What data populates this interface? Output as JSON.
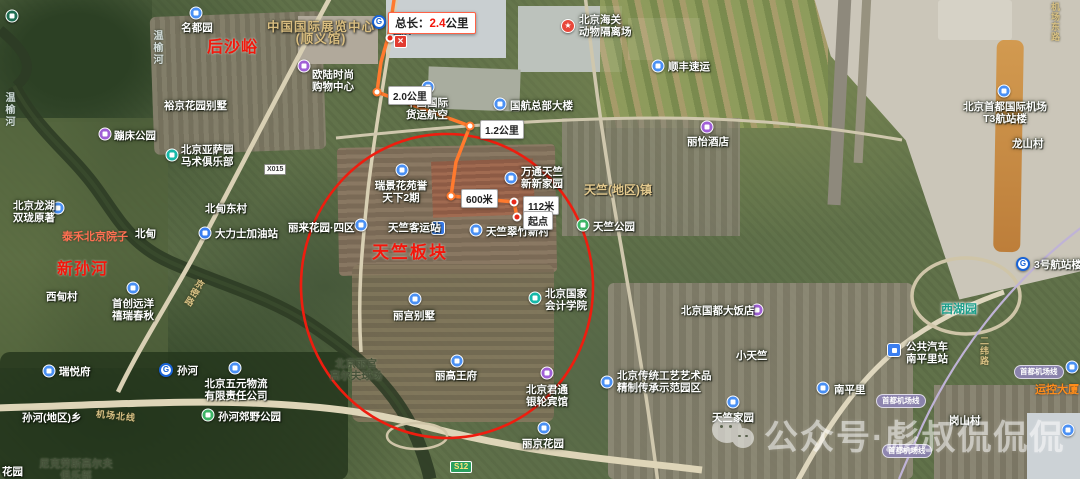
{
  "colors": {
    "route": "#ff7a2e",
    "ellipse": "#ee1d0f",
    "highlight_text": "#f3160b",
    "measure_border": "#ff6145",
    "pin_blue": "#4a90f4",
    "pin_purple": "#a05fd6",
    "pin_teal": "#16b8a8",
    "pin_green": "#3cb465",
    "badge_s12_bg": "#2aa060",
    "airport_line_badge_bg": "#8f86b8"
  },
  "measure": {
    "total_prefix": "总长：",
    "total_value": "2.4",
    "total_unit": "公里",
    "close_glyph": "×",
    "segments": [
      {
        "text": "2.0公里",
        "x": 388,
        "y": 86
      },
      {
        "text": "1.2公里",
        "x": 480,
        "y": 120
      },
      {
        "text": "600米",
        "x": 461,
        "y": 189
      },
      {
        "text": "112米",
        "x": 523,
        "y": 196
      },
      {
        "text": "起点",
        "x": 523,
        "y": 211,
        "name": "route-start-label"
      }
    ]
  },
  "route": {
    "points": "394,0 389,34 381,62 377,92 470,126 456,162 451,196 514,202 517,217",
    "waypoints": [
      {
        "x": 390,
        "y": 38,
        "red": true
      },
      {
        "x": 377,
        "y": 92,
        "red": false
      },
      {
        "x": 470,
        "y": 126,
        "red": false
      },
      {
        "x": 451,
        "y": 196,
        "red": false
      },
      {
        "x": 514,
        "y": 202,
        "red": true
      },
      {
        "x": 517,
        "y": 217,
        "red": true
      }
    ]
  },
  "highlight_ellipse": {
    "cx": 447,
    "cy": 286,
    "rx": 146,
    "ry": 152
  },
  "watermark": {
    "icon": "wechat-icon",
    "text": "公众号·彪叔侃侃侃"
  },
  "map": {
    "places": [
      {
        "marker": {
          "type": "pin",
          "color": "#1f6e52",
          "x": 12,
          "y": 16
        },
        "lines": [],
        "interact": true
      },
      {
        "marker": {
          "type": "pin",
          "color": "#4a90f4",
          "x": 196,
          "y": 13
        },
        "lines": [
          "名都园"
        ],
        "lx": 197,
        "ly": 22,
        "align": "c",
        "style": "white",
        "interact": true
      },
      {
        "marker": {
          "type": "pin",
          "color": "#a05fd6",
          "x": 304,
          "y": 66
        },
        "lines": [
          "欧陆时尚",
          "购物中心"
        ],
        "lx": 333,
        "ly": 69,
        "align": "c",
        "style": "white",
        "interact": true
      },
      {
        "marker": null,
        "lines": [
          "裕京花园别墅"
        ],
        "lx": 164,
        "ly": 100,
        "align": "l",
        "style": "white",
        "interact": false
      },
      {
        "marker": {
          "type": "metro",
          "x": 379,
          "y": 22
        },
        "lines": [
          "国展"
        ],
        "lx": 393,
        "ly": 25,
        "align": "l",
        "style": "station",
        "interact": true
      },
      {
        "marker": {
          "type": "star",
          "x": 568,
          "y": 26
        },
        "lines": [
          "北京海关",
          "动物隔离场"
        ],
        "lx": 579,
        "ly": 14,
        "align": "l",
        "style": "white",
        "interact": true
      },
      {
        "marker": {
          "type": "pin",
          "color": "#4a90f4",
          "x": 658,
          "y": 66
        },
        "lines": [
          "顺丰速运"
        ],
        "lx": 668,
        "ly": 61,
        "align": "l",
        "style": "white",
        "interact": true
      },
      {
        "marker": null,
        "lines": [
          "中国国际展览中心",
          "(顺义馆)"
        ],
        "lx": 321,
        "ly": 21,
        "align": "c",
        "style": "tan-lg",
        "interact": false
      },
      {
        "marker": null,
        "lines": [
          "后沙峪"
        ],
        "lx": 207,
        "ly": 42,
        "align": "l",
        "style": "red-lg",
        "interact": false
      },
      {
        "marker": null,
        "lines": [
          "温榆河"
        ],
        "lx": 150,
        "ly": 30,
        "align": "l",
        "style": "river",
        "interact": false
      },
      {
        "marker": null,
        "lines": [
          "温榆河"
        ],
        "lx": 2,
        "ly": 92,
        "align": "l",
        "style": "river",
        "interact": false
      },
      {
        "marker": {
          "type": "pin",
          "color": "#4a90f4",
          "x": 428,
          "y": 87
        },
        "lines": [
          "中国国际",
          "货运航空"
        ],
        "lx": 427,
        "ly": 97,
        "align": "c",
        "style": "white",
        "interact": true
      },
      {
        "marker": {
          "type": "pin",
          "color": "#4a90f4",
          "x": 500,
          "y": 104
        },
        "lines": [
          "国航总部大楼"
        ],
        "lx": 510,
        "ly": 100,
        "align": "l",
        "style": "white",
        "interact": true
      },
      {
        "marker": {
          "type": "pin",
          "color": "#a05fd6",
          "x": 707,
          "y": 127
        },
        "lines": [
          "丽怡酒店"
        ],
        "lx": 708,
        "ly": 136,
        "align": "c",
        "style": "white",
        "interact": true
      },
      {
        "marker": {
          "type": "pin",
          "color": "#4a90f4",
          "x": 1004,
          "y": 91
        },
        "lines": [
          "北京首都国际机场",
          "T3航站楼"
        ],
        "lx": 1005,
        "ly": 101,
        "align": "c",
        "style": "white",
        "interact": true
      },
      {
        "marker": null,
        "lines": [
          "龙山村"
        ],
        "lx": 1012,
        "ly": 138,
        "align": "l",
        "style": "white",
        "interact": false
      },
      {
        "marker": {
          "type": "pin",
          "color": "#a05fd6",
          "x": 105,
          "y": 134
        },
        "lines": [
          "蹦床公园"
        ],
        "lx": 114,
        "ly": 130,
        "align": "l",
        "style": "white",
        "interact": true
      },
      {
        "marker": {
          "type": "pin",
          "color": "#16b8a8",
          "x": 172,
          "y": 155
        },
        "lines": [
          "北京亚萨园",
          "马术俱乐部"
        ],
        "lx": 181,
        "ly": 144,
        "align": "l",
        "style": "white",
        "interact": true
      },
      {
        "marker": {
          "type": "pin",
          "color": "#4a90f4",
          "x": 58,
          "y": 208
        },
        "lines": [
          "北京龙湖",
          "双珑原著"
        ],
        "lx": 13,
        "ly": 200,
        "align": "l",
        "style": "white",
        "interact": true
      },
      {
        "marker": null,
        "lines": [
          "北甸东村"
        ],
        "lx": 205,
        "ly": 203,
        "align": "l",
        "style": "white",
        "interact": false
      },
      {
        "marker": null,
        "lines": [
          "北甸"
        ],
        "lx": 135,
        "ly": 228,
        "align": "l",
        "style": "white",
        "interact": false
      },
      {
        "marker": {
          "type": "gas",
          "color": "#3a7ef0",
          "x": 205,
          "y": 233
        },
        "lines": [
          "大力士加油站"
        ],
        "lx": 215,
        "ly": 228,
        "align": "l",
        "style": "white",
        "interact": true
      },
      {
        "marker": null,
        "lines": [
          "泰禾北京院子"
        ],
        "lx": 62,
        "ly": 231,
        "align": "l",
        "style": "orange",
        "interact": false
      },
      {
        "marker": null,
        "lines": [
          "新孙河"
        ],
        "lx": 57,
        "ly": 264,
        "align": "l",
        "style": "red-lg",
        "interact": false
      },
      {
        "marker": null,
        "lines": [
          "西甸村"
        ],
        "lx": 46,
        "ly": 291,
        "align": "l",
        "style": "white",
        "interact": false
      },
      {
        "marker": {
          "type": "pin",
          "color": "#4a90f4",
          "x": 133,
          "y": 288
        },
        "lines": [
          "首创远洋",
          "禧瑞春秋"
        ],
        "lx": 133,
        "ly": 298,
        "align": "c",
        "style": "white",
        "interact": true
      },
      {
        "marker": {
          "type": "pin",
          "color": "#4a90f4",
          "x": 402,
          "y": 170
        },
        "lines": [
          "瑞景花苑誉",
          "天下2期"
        ],
        "lx": 401,
        "ly": 180,
        "align": "c",
        "style": "white",
        "interact": true
      },
      {
        "marker": {
          "type": "pin",
          "color": "#4a90f4",
          "x": 511,
          "y": 178
        },
        "lines": [
          "万通天竺",
          "新新家园"
        ],
        "lx": 521,
        "ly": 166,
        "align": "l",
        "style": "white",
        "interact": true
      },
      {
        "marker": null,
        "lines": [
          "天竺(地区)镇"
        ],
        "lx": 584,
        "ly": 184,
        "align": "l",
        "style": "tan",
        "interact": false
      },
      {
        "marker": {
          "type": "pin",
          "color": "#4a90f4",
          "x": 361,
          "y": 225
        },
        "lines": [
          "丽来花园·四区"
        ],
        "lx": 288,
        "ly": 222,
        "align": "l",
        "style": "white",
        "interact": true
      },
      {
        "marker": {
          "type": "transit",
          "color": "#3a7ef0",
          "x": 438,
          "y": 228
        },
        "lines": [
          "天竺客运站"
        ],
        "lx": 388,
        "ly": 222,
        "align": "l",
        "style": "white",
        "interact": true
      },
      {
        "marker": {
          "type": "pin",
          "color": "#4a90f4",
          "x": 476,
          "y": 230
        },
        "lines": [
          "天竺翠竹新村"
        ],
        "lx": 486,
        "ly": 226,
        "align": "l",
        "style": "white",
        "interact": true
      },
      {
        "marker": {
          "type": "pin",
          "color": "#3cb465",
          "x": 583,
          "y": 225
        },
        "lines": [
          "天竺公园"
        ],
        "lx": 593,
        "ly": 221,
        "align": "l",
        "style": "white",
        "interact": true
      },
      {
        "marker": null,
        "lines": [
          "天竺板块"
        ],
        "lx": 372,
        "ly": 247,
        "align": "l",
        "style": "red-xl",
        "interact": false
      },
      {
        "marker": {
          "type": "pin",
          "color": "#16b8a8",
          "x": 535,
          "y": 298
        },
        "lines": [
          "北京国家",
          "会计学院"
        ],
        "lx": 545,
        "ly": 288,
        "align": "l",
        "style": "white",
        "interact": true
      },
      {
        "marker": {
          "type": "pin",
          "color": "#4a90f4",
          "x": 415,
          "y": 299
        },
        "lines": [
          "丽宫别墅"
        ],
        "lx": 414,
        "ly": 310,
        "align": "c",
        "style": "white",
        "interact": true
      },
      {
        "marker": {
          "type": "pin",
          "color": "#a05fd6",
          "x": 757,
          "y": 310
        },
        "lines": [
          "北京国都大饭店"
        ],
        "lx": 681,
        "ly": 305,
        "align": "l",
        "style": "white",
        "interact": true
      },
      {
        "marker": null,
        "lines": [
          "小天竺"
        ],
        "lx": 736,
        "ly": 350,
        "align": "l",
        "style": "white",
        "interact": false
      },
      {
        "marker": null,
        "lines": [
          "北京丽宫",
          "高尔夫球场"
        ],
        "lx": 356,
        "ly": 358,
        "align": "c",
        "style": "olive",
        "interact": false
      },
      {
        "marker": {
          "type": "pin",
          "color": "#4a90f4",
          "x": 457,
          "y": 361
        },
        "lines": [
          "丽高王府"
        ],
        "lx": 456,
        "ly": 370,
        "align": "c",
        "style": "white",
        "interact": true
      },
      {
        "marker": {
          "type": "pin",
          "color": "#a05fd6",
          "x": 547,
          "y": 373
        },
        "lines": [
          "北京君通",
          "银轮宾馆"
        ],
        "lx": 547,
        "ly": 384,
        "align": "c",
        "style": "white",
        "interact": true
      },
      {
        "marker": {
          "type": "pin",
          "color": "#4a90f4",
          "x": 607,
          "y": 382
        },
        "lines": [
          "北京传统工艺艺术品",
          "精制传承示范园区"
        ],
        "lx": 617,
        "ly": 370,
        "align": "l",
        "style": "white",
        "interact": true
      },
      {
        "marker": {
          "type": "pin",
          "color": "#4a90f4",
          "x": 544,
          "y": 428
        },
        "lines": [
          "丽京花园"
        ],
        "lx": 543,
        "ly": 438,
        "align": "c",
        "style": "white",
        "interact": true
      },
      {
        "marker": {
          "type": "pin",
          "color": "#4a90f4",
          "x": 49,
          "y": 371
        },
        "lines": [
          "瑞悦府"
        ],
        "lx": 59,
        "ly": 366,
        "align": "l",
        "style": "white",
        "interact": true
      },
      {
        "marker": {
          "type": "metro",
          "x": 166,
          "y": 370
        },
        "lines": [
          "孙河"
        ],
        "lx": 177,
        "ly": 365,
        "align": "l",
        "style": "white",
        "interact": true
      },
      {
        "marker": {
          "type": "pin",
          "color": "#4a90f4",
          "x": 235,
          "y": 368
        },
        "lines": [
          "北京五元物流",
          "有限责任公司"
        ],
        "lx": 236,
        "ly": 378,
        "align": "c",
        "style": "white",
        "interact": true
      },
      {
        "marker": {
          "type": "pin",
          "color": "#3cb465",
          "x": 208,
          "y": 415
        },
        "lines": [
          "孙河郊野公园"
        ],
        "lx": 218,
        "ly": 411,
        "align": "l",
        "style": "white",
        "interact": true
      },
      {
        "marker": null,
        "lines": [
          "孙河(地区)乡"
        ],
        "lx": 22,
        "ly": 412,
        "align": "l",
        "style": "white",
        "interact": false
      },
      {
        "marker": null,
        "lines": [
          "尼克劳斯高尔夫",
          "俱乐部"
        ],
        "lx": 76,
        "ly": 458,
        "align": "c",
        "style": "olive",
        "interact": false
      },
      {
        "marker": null,
        "lines": [
          "花园"
        ],
        "lx": 2,
        "ly": 466,
        "align": "l",
        "style": "white",
        "interact": false
      },
      {
        "marker": {
          "type": "pin",
          "color": "#4a90f4",
          "x": 733,
          "y": 402
        },
        "lines": [
          "天竺家园"
        ],
        "lx": 733,
        "ly": 412,
        "align": "c",
        "style": "white",
        "interact": true
      },
      {
        "marker": {
          "type": "pin",
          "color": "#4a90f4",
          "x": 823,
          "y": 388
        },
        "lines": [
          "南平里"
        ],
        "lx": 834,
        "ly": 384,
        "align": "l",
        "style": "white",
        "interact": true
      },
      {
        "marker": {
          "type": "bus",
          "color": "#3a7ef0",
          "x": 894,
          "y": 350
        },
        "lines": [
          "公共汽车",
          "南平里站"
        ],
        "lx": 906,
        "ly": 341,
        "align": "l",
        "style": "white",
        "interact": true
      },
      {
        "marker": null,
        "lines": [
          "岗山村"
        ],
        "lx": 949,
        "ly": 415,
        "align": "l",
        "style": "white",
        "interact": false
      },
      {
        "marker": null,
        "lines": [
          "西湖园"
        ],
        "lx": 941,
        "ly": 303,
        "align": "l",
        "style": "teal",
        "interact": false
      },
      {
        "marker": {
          "type": "metro",
          "x": 1023,
          "y": 264
        },
        "lines": [
          "3号航站楼"
        ],
        "lx": 1034,
        "ly": 259,
        "align": "l",
        "style": "white",
        "interact": true
      },
      {
        "marker": {
          "type": "pin",
          "color": "#4a90f4",
          "x": 1072,
          "y": 367
        },
        "lines": [
          "运控大厦"
        ],
        "lx": 1035,
        "ly": 384,
        "align": "l",
        "style": "orangepoi",
        "interact": true
      },
      {
        "marker": {
          "type": "pin",
          "color": "#4a90f4",
          "x": 1068,
          "y": 430
        },
        "lines": [],
        "interact": true
      }
    ],
    "road_labels": [
      {
        "kind": "road",
        "text": "京密路",
        "x": 188,
        "y": 278,
        "vert": true,
        "rot": 30
      },
      {
        "kind": "road",
        "text": "机场北线",
        "x": 96,
        "y": 409,
        "vert": false,
        "rot": 6
      },
      {
        "kind": "road",
        "text": "二纬路",
        "x": 978,
        "y": 336,
        "vert": true,
        "rot": 0
      },
      {
        "kind": "road",
        "text": "机场东路",
        "x": 1049,
        "y": 2,
        "vert": true,
        "rot": 0
      },
      {
        "kind": "badge-white",
        "text": "X015",
        "x": 264,
        "y": 164
      },
      {
        "kind": "badge-s12",
        "text": "S12",
        "x": 450,
        "y": 461
      },
      {
        "kind": "badge-pill",
        "text": "首都机场线",
        "x": 876,
        "y": 394
      },
      {
        "kind": "badge-pill",
        "text": "首都机场线",
        "x": 882,
        "y": 444
      },
      {
        "kind": "badge-pill",
        "text": "首都机场线",
        "x": 1014,
        "y": 365
      }
    ]
  }
}
